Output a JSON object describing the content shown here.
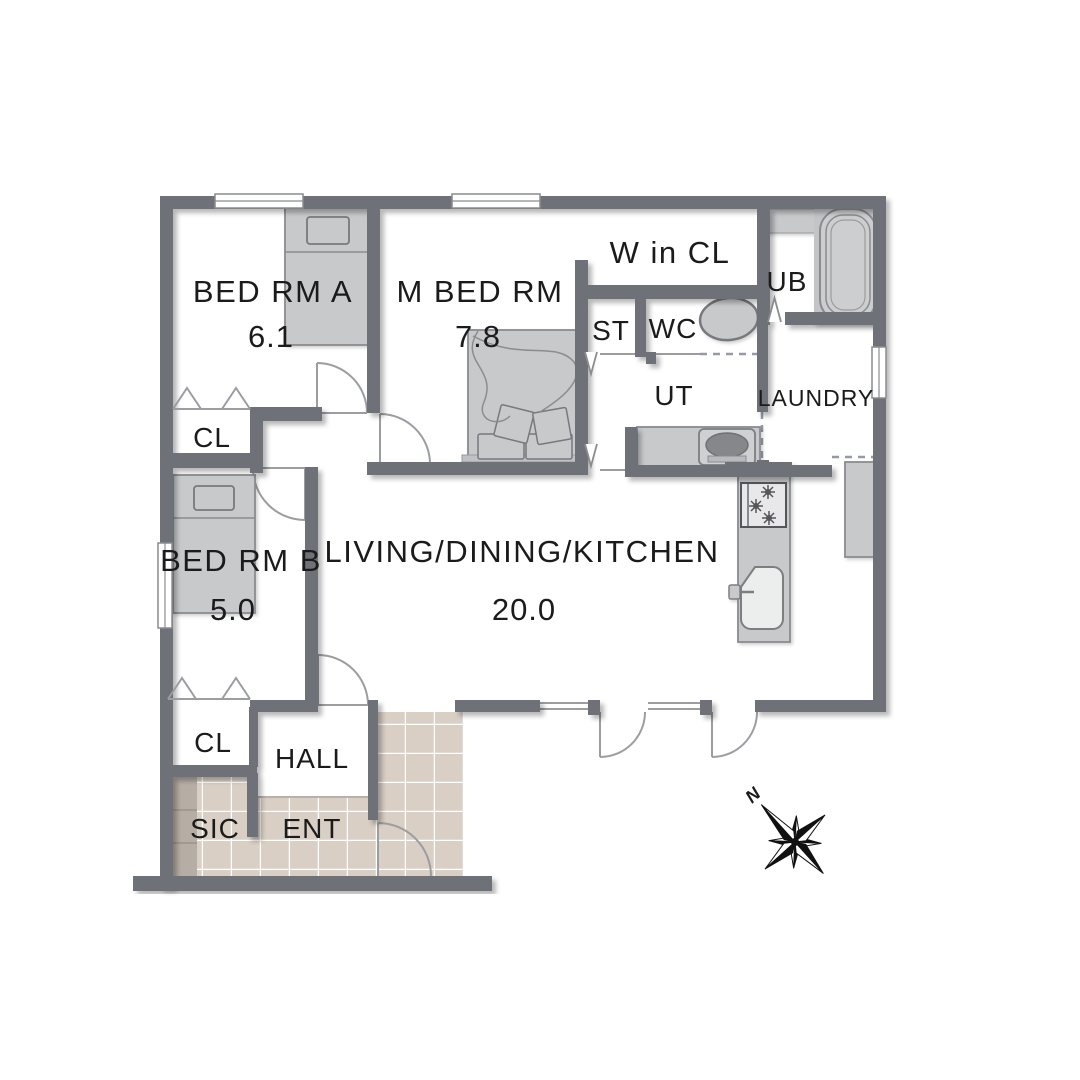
{
  "title": "Apartment floor plan",
  "colors": {
    "wall": "#6e7177",
    "floor": "#ffffff",
    "tile": "#d9cfc4",
    "tile_grout": "#ffffff",
    "shoe_shelf": "#b6ada4",
    "furniture_fill": "#c8c9cb",
    "furniture_stroke": "#8a8c90",
    "label_text": "#1b1b1b",
    "compass": "#111111"
  },
  "rooms": {
    "bed_rm_a": {
      "label": "BED RM A",
      "area": "6.1"
    },
    "m_bed_rm": {
      "label": "M BED RM",
      "area": "7.8"
    },
    "w_in_cl": {
      "label": "W in CL"
    },
    "ub": {
      "label": "UB"
    },
    "st": {
      "label": "ST"
    },
    "wc": {
      "label": "WC"
    },
    "ut": {
      "label": "UT"
    },
    "laundry": {
      "label": "LAUNDRY"
    },
    "bed_rm_b": {
      "label": "BED RM B",
      "area": "5.0"
    },
    "ldk": {
      "label": "LIVING/DINING/KITCHEN",
      "area": "20.0"
    },
    "cl_upper": {
      "label": "CL"
    },
    "cl_lower": {
      "label": "CL"
    },
    "hall": {
      "label": "HALL"
    },
    "sic": {
      "label": "SIC"
    },
    "ent": {
      "label": "ENT"
    }
  },
  "fixtures": [
    "single-bed-a",
    "single-bed-b",
    "double-bed",
    "bathtub",
    "toilet",
    "washing-machine",
    "kitchen-counter",
    "stove",
    "sink",
    "refrigerator",
    "shoe-shelf"
  ],
  "compass": {
    "north_label": "N"
  }
}
